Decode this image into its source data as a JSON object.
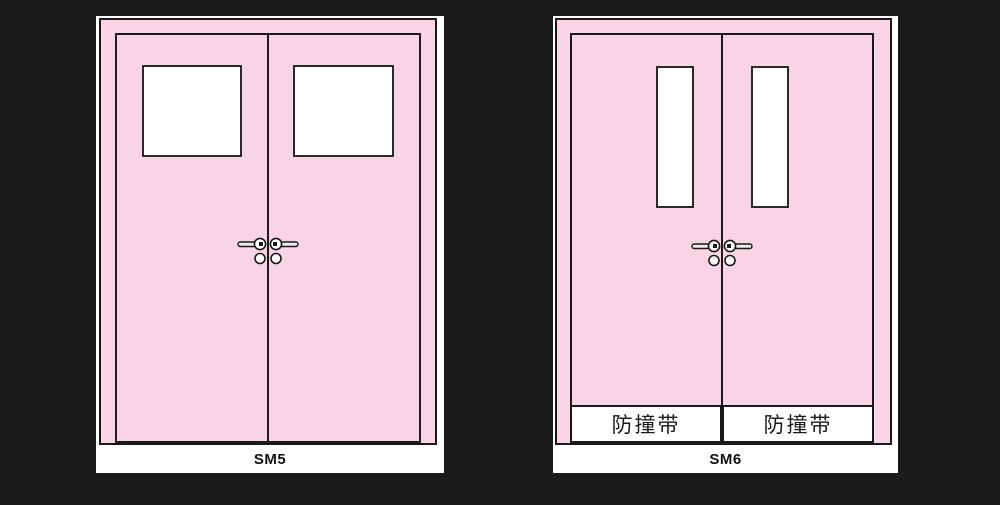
{
  "scene": {
    "background_color": "#1b1b1b",
    "door_color": "#f8d4e4",
    "outline_color": "#1a1a1a",
    "panel_color": "#ffffff"
  },
  "units": [
    {
      "label": "SM5"
    },
    {
      "label": "SM6",
      "bands": [
        "防撞带",
        "防撞带"
      ]
    }
  ]
}
